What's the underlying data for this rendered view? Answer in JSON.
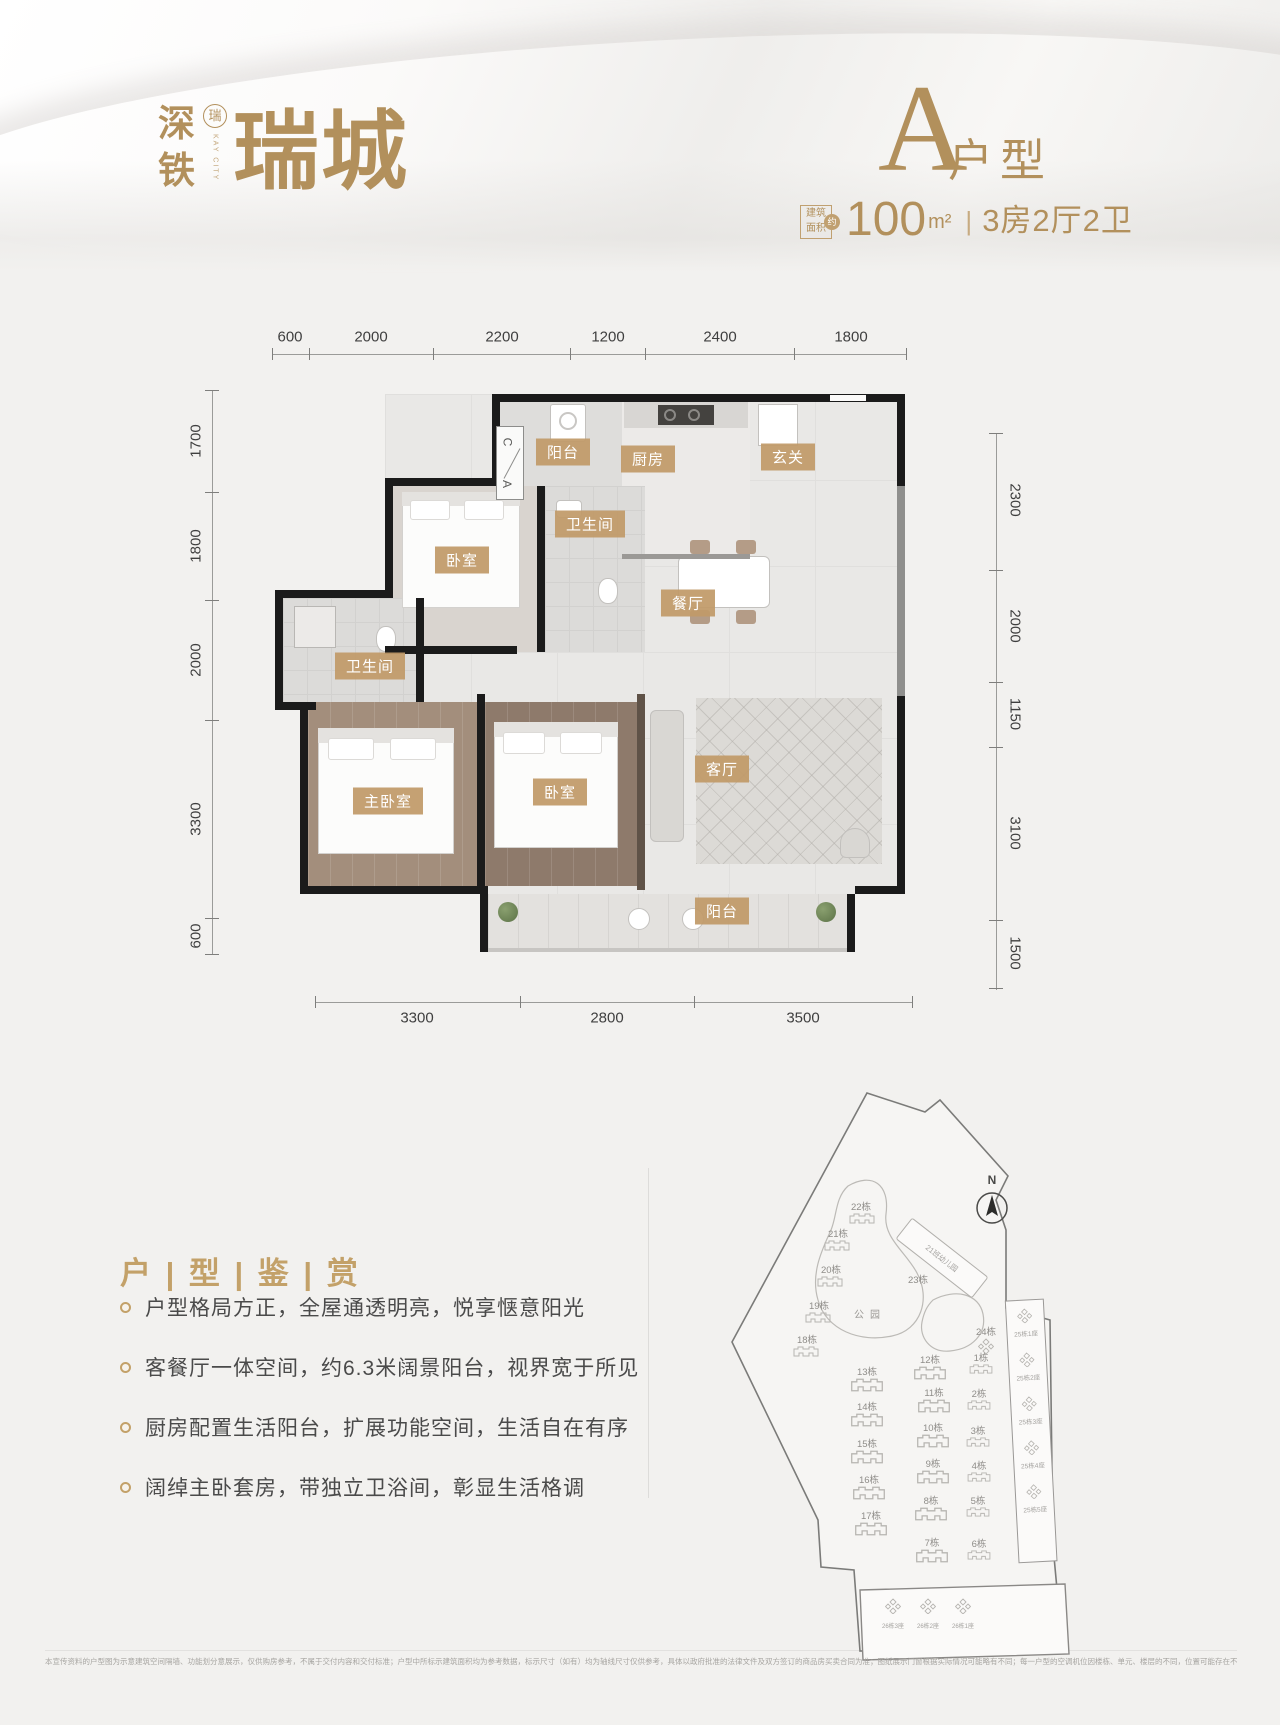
{
  "colors": {
    "gold": "#b2905c",
    "chip": "#c19a68",
    "wall": "#1b1b1b",
    "accent": "#c3a169"
  },
  "header": {
    "logo": {
      "char1": "深",
      "char2": "铁",
      "seal": "瑞",
      "vertical": "KAY CITY",
      "main": "瑞城"
    },
    "unit_letter": "A",
    "unit_suffix": "户型",
    "area": {
      "badge_line1": "建筑",
      "badge_line2": "面积",
      "badge_circle": "约",
      "value": "100",
      "unit": "m²",
      "divider": "|",
      "rooms": "3房2厅2卫"
    }
  },
  "floorplan": {
    "dims_top": [
      "600",
      "2000",
      "2200",
      "1200",
      "2400",
      "1800"
    ],
    "dims_left": [
      "1700",
      "1800",
      "2000",
      "3300",
      "600"
    ],
    "dims_right": [
      "2300",
      "2000",
      "1150",
      "3100",
      "1500"
    ],
    "dims_bottom": [
      "3300",
      "2800",
      "3500"
    ],
    "rooms": [
      "阳台",
      "厨房",
      "玄关",
      "卫生间",
      "卧室",
      "餐厅",
      "卫生间",
      "主卧室",
      "卧室",
      "客厅",
      "阳台"
    ],
    "shaft_top": "C",
    "shaft_bottom": "A"
  },
  "features": {
    "title": "户 | 型 | 鉴 | 赏",
    "items": [
      "户型格局方正，全屋通透明亮，悦享惬意阳光",
      "客餐厅一体空间，约6.3米阔景阳台，视界宽于所见",
      "厨房配置生活阳台，扩展功能空间，生活自在有序",
      "阔绰主卧套房，带独立卫浴间，彰显生活格调"
    ]
  },
  "sitemap": {
    "north": "N",
    "park": "公园",
    "kindergarten": "21班幼儿园",
    "towers": [
      "22栋",
      "21栋",
      "20栋",
      "19栋",
      "18栋",
      "23栋",
      "13栋",
      "14栋",
      "15栋",
      "16栋",
      "17栋",
      "12栋",
      "11栋",
      "10栋",
      "9栋",
      "8栋",
      "7栋",
      "24栋",
      "1栋",
      "2栋",
      "3栋",
      "4栋",
      "5栋",
      "6栋"
    ],
    "strip": [
      "25栋1座",
      "25栋2座",
      "25栋3座",
      "25栋4座",
      "25栋5座"
    ],
    "bottom": [
      "26栋3座",
      "26栋2座",
      "26栋1座"
    ]
  },
  "footer": {
    "disclaimer": "本宣传资料的户型图为示意建筑空间隔墙、功能划分意展示，仅供购房参考，不属于交付内容和交付标准；户型中所标示建筑面积均为参考数据，标示尺寸（如有）均为轴线尺寸仅供参考，具体以政府批准的法律文件及双方签订的商品房买卖合同为准；图纸展示门窗根据实际情况可能略有不同；每一户型的空调机位因楼栋、单元、楼层的不同，位置可能存在不同；相同户型因所处楼栋、单元、楼层不同，飘窗结构、面积、管线布置等可能有所不同；具体交付标准以实际交付为准；法律许可范围内，我司保留对本资料不时修改的权利，改建、扩建或改变房屋结构者需依法自行承担责任，开发商对本资料拥有最终解释权。开发商：深圳市地铁集团有限公司；代理机构：深圳世联行地产服务有限公司；制作日期：2024年11月。"
  }
}
